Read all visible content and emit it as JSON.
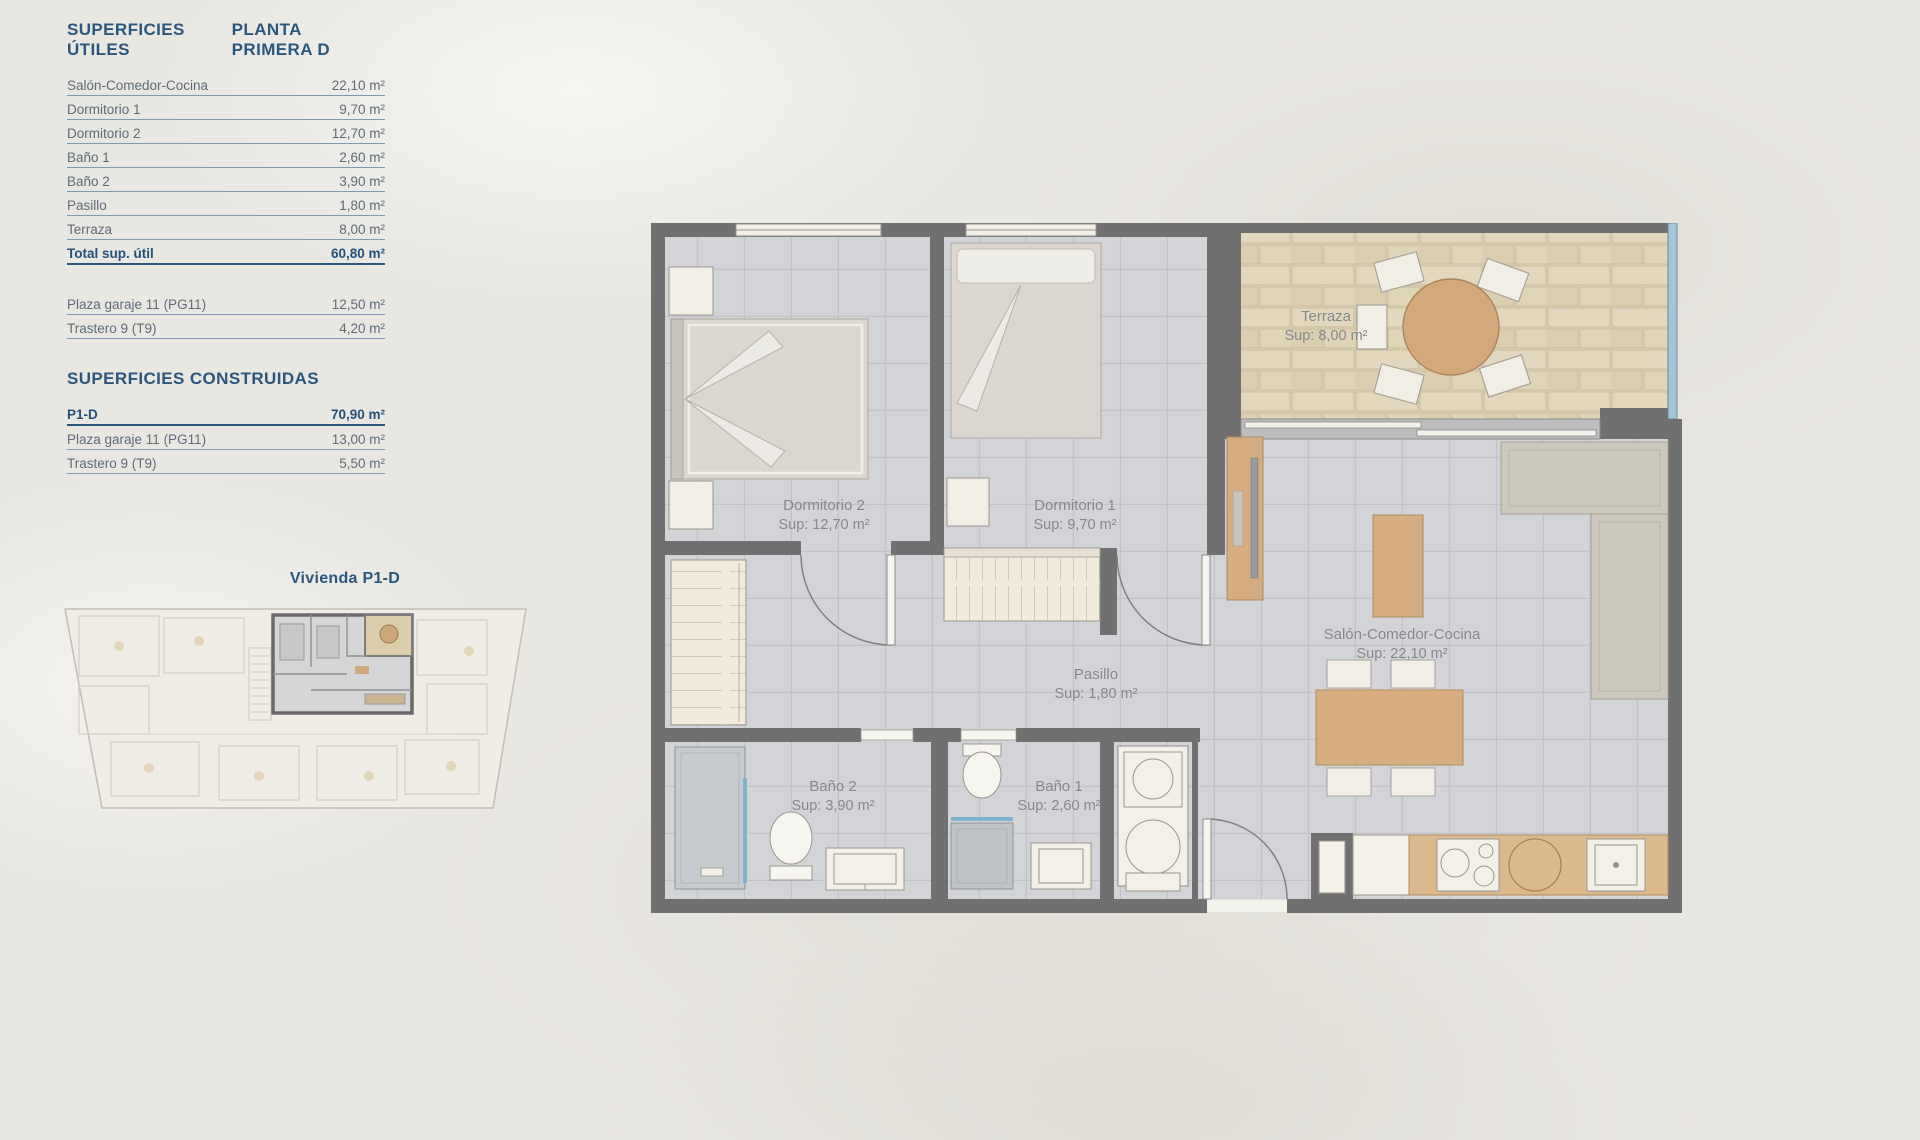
{
  "left_panel": {
    "utiles": {
      "title": "SUPERFICIES ÚTILES",
      "floor": "PLANTA PRIMERA D",
      "rows": [
        {
          "label": "Salón-Comedor-Cocina",
          "value": "22,10 m²"
        },
        {
          "label": "Dormitorio 1",
          "value": "9,70 m²"
        },
        {
          "label": "Dormitorio 2",
          "value": "12,70 m²"
        },
        {
          "label": "Baño 1",
          "value": "2,60 m²"
        },
        {
          "label": "Baño 2",
          "value": "3,90 m²"
        },
        {
          "label": "Pasillo",
          "value": "1,80 m²"
        },
        {
          "label": "Terraza",
          "value": "8,00 m²"
        }
      ],
      "total": {
        "label": "Total sup. útil",
        "value": "60,80 m²"
      },
      "annex_rows": [
        {
          "label": "Plaza garaje 11 (PG11)",
          "value": "12,50 m²"
        },
        {
          "label": "Trastero 9 (T9)",
          "value": "4,20 m²"
        }
      ]
    },
    "construidas": {
      "title": "SUPERFICIES CONSTRUIDAS",
      "rows": [
        {
          "label": "P1-D",
          "value": "70,90 m²"
        },
        {
          "label": "Plaza garaje 11 (PG11)",
          "value": "13,00 m²"
        },
        {
          "label": "Trastero 9 (T9)",
          "value": "5,50 m²"
        }
      ]
    },
    "mini_plan_title": "Vivienda P1-D"
  },
  "floor_plan": {
    "rooms": {
      "terraza": {
        "name": "Terraza",
        "sup": "Sup: 8,00 m²"
      },
      "dormitorio2": {
        "name": "Dormitorio 2",
        "sup": "Sup: 12,70 m²"
      },
      "dormitorio1": {
        "name": "Dormitorio 1",
        "sup": "Sup: 9,70 m²"
      },
      "salon": {
        "name": "Salón-Comedor-Cocina",
        "sup": "Sup: 22,10 m²"
      },
      "pasillo": {
        "name": "Pasillo",
        "sup": "Sup: 1,80 m²"
      },
      "bano2": {
        "name": "Baño 2",
        "sup": "Sup: 3,90 m²"
      },
      "bano1": {
        "name": "Baño 1",
        "sup": "Sup: 2,60 m²"
      }
    }
  },
  "colors": {
    "accent_blue": "#2b567d",
    "row_text": "#5e6b78",
    "wall_gray": "#707070",
    "floor_tile": "#d3d4d7",
    "terrace_tile": "#ded2b5",
    "wood": "#d5ad80",
    "glass_blue": "#a5c4d6",
    "label_gray": "#85878b"
  }
}
